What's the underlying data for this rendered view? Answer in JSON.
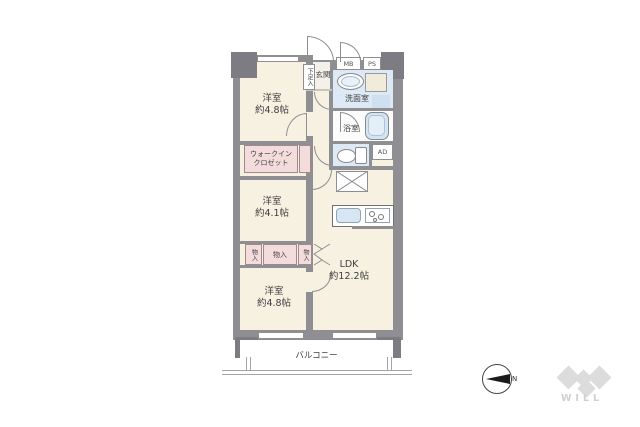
{
  "rooms": {
    "bedroom_top": {
      "name": "洋室",
      "size": "約4.8帖"
    },
    "bedroom_mid": {
      "name": "洋室",
      "size": "約4.1帖"
    },
    "bedroom_bottom": {
      "name": "洋室",
      "size": "約4.8帖"
    },
    "ldk": {
      "name": "LDK",
      "size": "約12.2帖"
    },
    "wic": {
      "line1": "ウォークイン",
      "line2": "クロゼット"
    },
    "entrance": "玄関",
    "shoe_storage": "下足入",
    "washroom": "洗面室",
    "bathroom": "浴室",
    "balcony": "バルコニー"
  },
  "storage": {
    "left": "物入",
    "middle": "物入",
    "right": "物入"
  },
  "utility": {
    "mb": "MB",
    "ps": "PS",
    "ad": "AD"
  },
  "compass": {
    "north_label": "N"
  },
  "brand": {
    "logo_text": "WILL"
  },
  "colors": {
    "wall": "#8e8e93",
    "pillar": "#7c7c82",
    "floor": "#f7f1e2",
    "closet_pink": "#f4dbdc",
    "wet_blue": "#dde9f4",
    "fixture_blue": "#d3e4f2"
  }
}
